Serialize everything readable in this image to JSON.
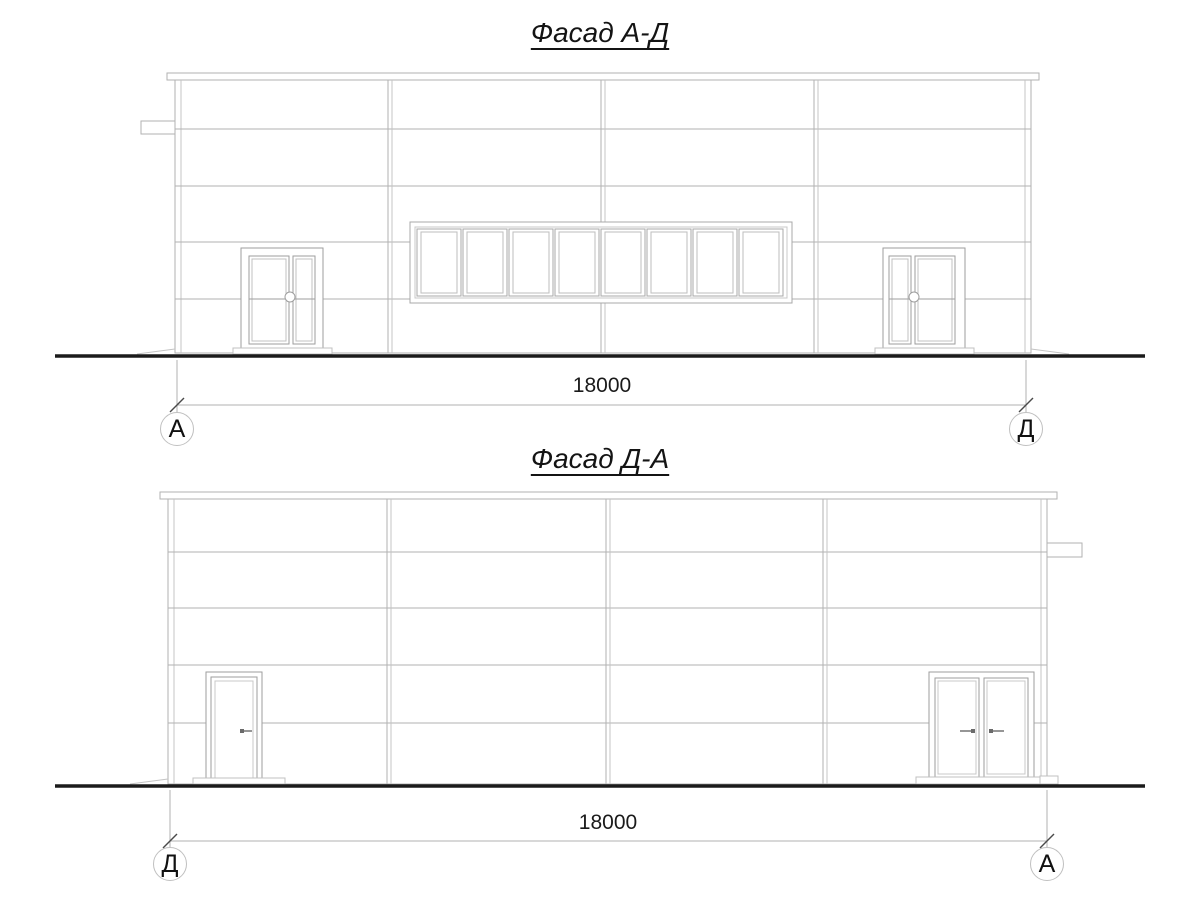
{
  "facade_top": {
    "title": "Фасад А-Д",
    "dimension_label": "18000",
    "axis_marker_left": "А",
    "axis_marker_right": "Д"
  },
  "facade_bottom": {
    "title": "Фасад Д-А",
    "dimension_label": "18000",
    "axis_marker_left": "Д",
    "axis_marker_right": "А"
  },
  "colors": {
    "wall_line": "#b2b2b2",
    "frame_line": "#9e9e9e",
    "ground_line": "#1b1b1b",
    "dimension_line": "#b0b0b0",
    "tick_line": "#4a4a4a",
    "text": "#1a1a1a"
  }
}
